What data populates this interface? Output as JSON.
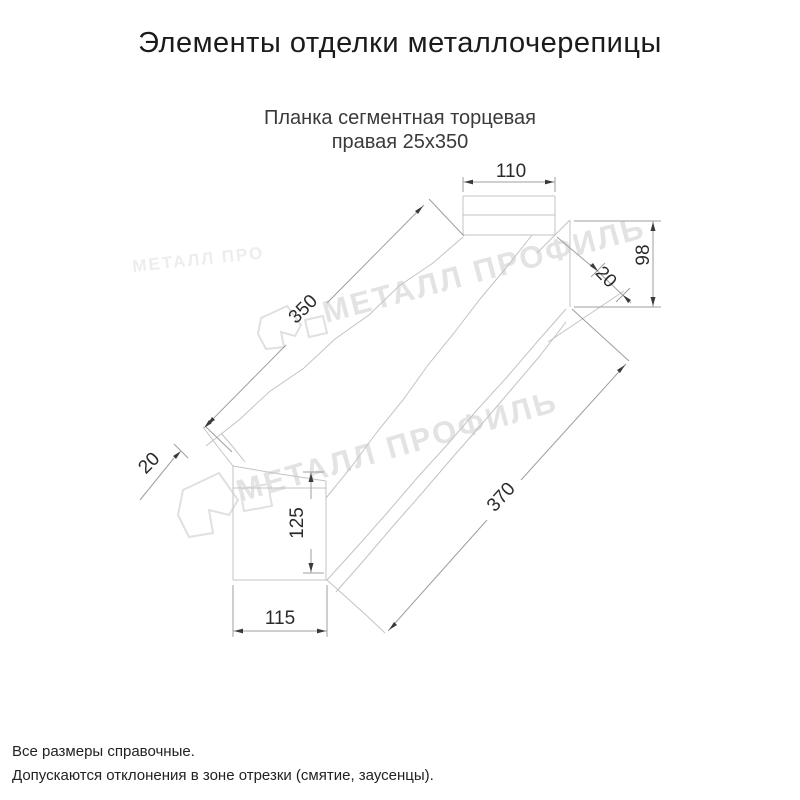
{
  "title": "Элементы отделки металлочерепицы",
  "product": {
    "line1": "Планка сегментная торцевая",
    "line2": "правая 25x350"
  },
  "drawing": {
    "dimensions": {
      "top_width": "110",
      "upper_length": "350",
      "left_end_fold": "20",
      "right_end_fold": "20",
      "end_height": "98",
      "bottom_tab_height": "125",
      "lower_length": "370",
      "bottom_tab_width": "115"
    }
  },
  "watermark": {
    "brand": "МЕТАЛЛ ПРОФИЛЬ",
    "brand_partial": "МЕТАЛЛ ПРО"
  },
  "footer": {
    "note1": "Все размеры справочные.",
    "note2": "Допускаются отклонения в зоне отрезки (смятие, заусенцы)."
  },
  "colors": {
    "part_line": "#c3c3c3",
    "dim_line": "#9f9f9f",
    "dim_text": "#2b2b2b",
    "arrow": "#3a3a3a",
    "watermark": "#e3e3e3",
    "title_text": "#1b1b1b",
    "subtitle_text": "#3a3a3a",
    "footer_text": "#222222"
  }
}
